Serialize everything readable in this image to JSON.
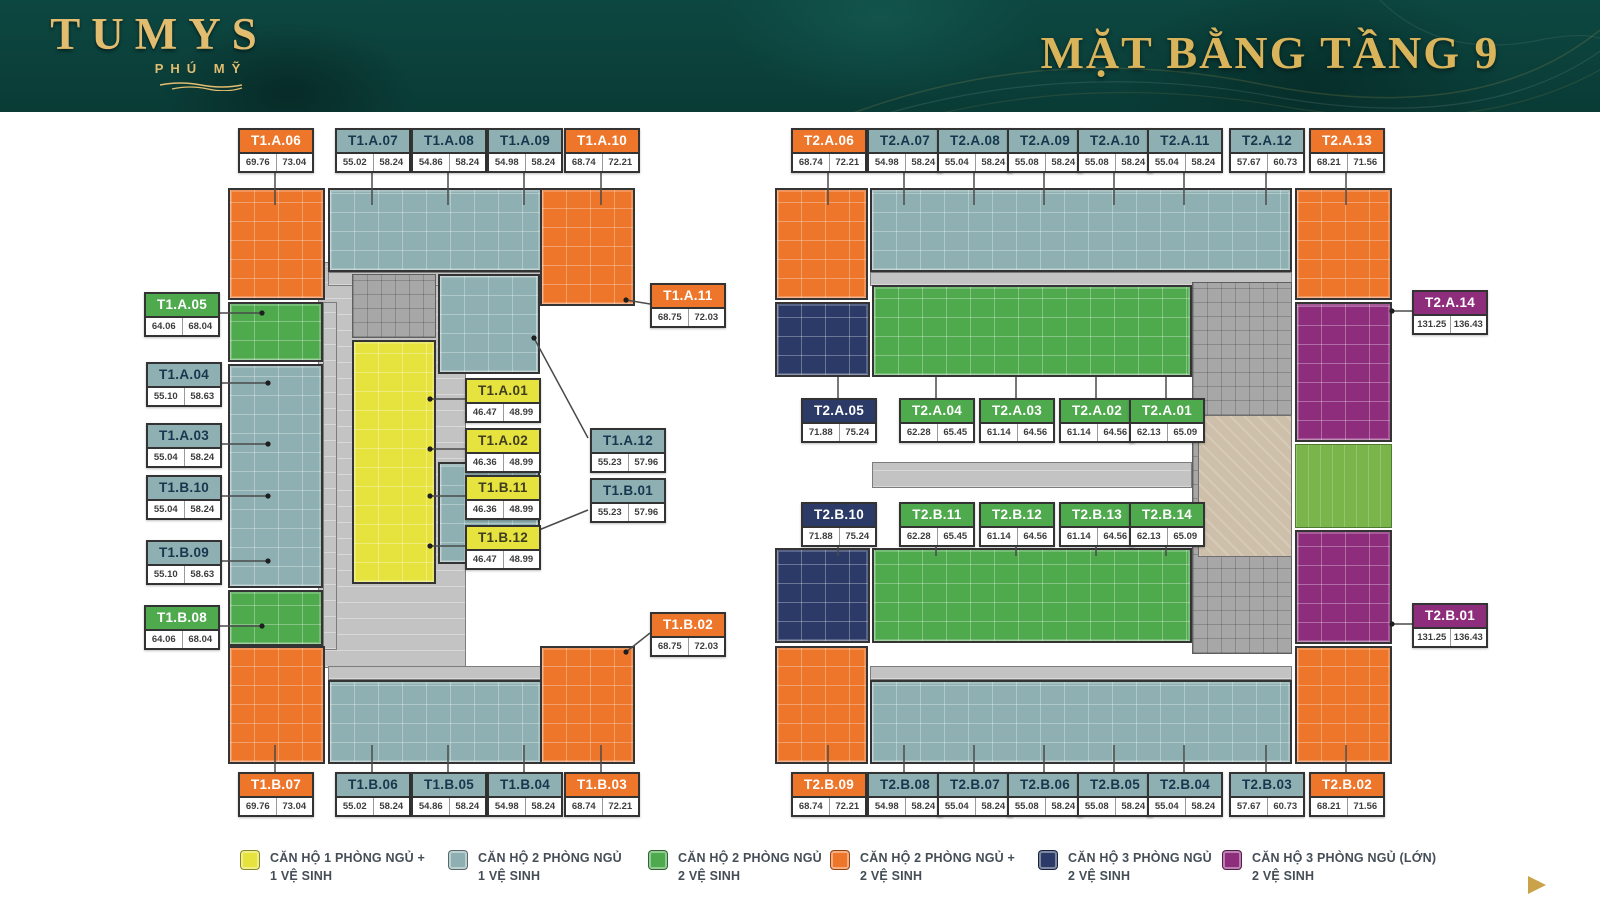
{
  "header": {
    "logo_title": "TUMYS",
    "logo_subtitle": "PHÚ MỸ",
    "page_title": "MẶT BẰNG TẦNG 9"
  },
  "colors": {
    "yellow": "#E6E23E",
    "teal": "#8FB0B2",
    "green": "#4FA94D",
    "orange": "#EE762B",
    "navy": "#2B3A67",
    "purple": "#8E2D7C",
    "header_bg": "#0C4540",
    "gold": "#D9B45B"
  },
  "towers": {
    "t1": {
      "units": [
        {
          "code": "T1.A.06",
          "area1": "69.76",
          "area2": "73.04",
          "type": "orange"
        },
        {
          "code": "T1.A.07",
          "area1": "55.02",
          "area2": "58.24",
          "type": "teal"
        },
        {
          "code": "T1.A.08",
          "area1": "54.86",
          "area2": "58.24",
          "type": "teal"
        },
        {
          "code": "T1.A.09",
          "area1": "54.98",
          "area2": "58.24",
          "type": "teal"
        },
        {
          "code": "T1.A.10",
          "area1": "68.74",
          "area2": "72.21",
          "type": "orange"
        },
        {
          "code": "T1.A.05",
          "area1": "64.06",
          "area2": "68.04",
          "type": "green"
        },
        {
          "code": "T1.A.04",
          "area1": "55.10",
          "area2": "58.63",
          "type": "teal"
        },
        {
          "code": "T1.A.03",
          "area1": "55.04",
          "area2": "58.24",
          "type": "teal"
        },
        {
          "code": "T1.B.10",
          "area1": "55.04",
          "area2": "58.24",
          "type": "teal"
        },
        {
          "code": "T1.B.09",
          "area1": "55.10",
          "area2": "58.63",
          "type": "teal"
        },
        {
          "code": "T1.B.08",
          "area1": "64.06",
          "area2": "68.04",
          "type": "green"
        },
        {
          "code": "T1.A.01",
          "area1": "46.47",
          "area2": "48.99",
          "type": "yellow"
        },
        {
          "code": "T1.A.02",
          "area1": "46.36",
          "area2": "48.99",
          "type": "yellow"
        },
        {
          "code": "T1.B.11",
          "area1": "46.36",
          "area2": "48.99",
          "type": "yellow"
        },
        {
          "code": "T1.B.12",
          "area1": "46.47",
          "area2": "48.99",
          "type": "yellow"
        },
        {
          "code": "T1.A.11",
          "area1": "68.75",
          "area2": "72.03",
          "type": "orange"
        },
        {
          "code": "T1.A.12",
          "area1": "55.23",
          "area2": "57.96",
          "type": "teal"
        },
        {
          "code": "T1.B.01",
          "area1": "55.23",
          "area2": "57.96",
          "type": "teal"
        },
        {
          "code": "T1.B.02",
          "area1": "68.75",
          "area2": "72.03",
          "type": "orange"
        },
        {
          "code": "T1.B.07",
          "area1": "69.76",
          "area2": "73.04",
          "type": "orange"
        },
        {
          "code": "T1.B.06",
          "area1": "55.02",
          "area2": "58.24",
          "type": "teal"
        },
        {
          "code": "T1.B.05",
          "area1": "54.86",
          "area2": "58.24",
          "type": "teal"
        },
        {
          "code": "T1.B.04",
          "area1": "54.98",
          "area2": "58.24",
          "type": "teal"
        },
        {
          "code": "T1.B.03",
          "area1": "68.74",
          "area2": "72.21",
          "type": "orange"
        }
      ]
    },
    "t2": {
      "units": [
        {
          "code": "T2.A.06",
          "area1": "68.74",
          "area2": "72.21",
          "type": "orange"
        },
        {
          "code": "T2.A.07",
          "area1": "54.98",
          "area2": "58.24",
          "type": "teal"
        },
        {
          "code": "T2.A.08",
          "area1": "55.04",
          "area2": "58.24",
          "type": "teal"
        },
        {
          "code": "T2.A.09",
          "area1": "55.08",
          "area2": "58.24",
          "type": "teal"
        },
        {
          "code": "T2.A.10",
          "area1": "55.08",
          "area2": "58.24",
          "type": "teal"
        },
        {
          "code": "T2.A.11",
          "area1": "55.04",
          "area2": "58.24",
          "type": "teal"
        },
        {
          "code": "T2.A.12",
          "area1": "57.67",
          "area2": "60.73",
          "type": "teal"
        },
        {
          "code": "T2.A.13",
          "area1": "68.21",
          "area2": "71.56",
          "type": "orange"
        },
        {
          "code": "T2.A.14",
          "area1": "131.25",
          "area2": "136.43",
          "type": "purple"
        },
        {
          "code": "T2.A.05",
          "area1": "71.88",
          "area2": "75.24",
          "type": "navy"
        },
        {
          "code": "T2.A.04",
          "area1": "62.28",
          "area2": "65.45",
          "type": "green"
        },
        {
          "code": "T2.A.03",
          "area1": "61.14",
          "area2": "64.56",
          "type": "green"
        },
        {
          "code": "T2.A.02",
          "area1": "61.14",
          "area2": "64.56",
          "type": "green"
        },
        {
          "code": "T2.A.01",
          "area1": "62.13",
          "area2": "65.09",
          "type": "green"
        },
        {
          "code": "T2.B.10",
          "area1": "71.88",
          "area2": "75.24",
          "type": "navy"
        },
        {
          "code": "T2.B.11",
          "area1": "62.28",
          "area2": "65.45",
          "type": "green"
        },
        {
          "code": "T2.B.12",
          "area1": "61.14",
          "area2": "64.56",
          "type": "green"
        },
        {
          "code": "T2.B.13",
          "area1": "61.14",
          "area2": "64.56",
          "type": "green"
        },
        {
          "code": "T2.B.14",
          "area1": "62.13",
          "area2": "65.09",
          "type": "green"
        },
        {
          "code": "T2.B.01",
          "area1": "131.25",
          "area2": "136.43",
          "type": "purple"
        },
        {
          "code": "T2.B.09",
          "area1": "68.74",
          "area2": "72.21",
          "type": "orange"
        },
        {
          "code": "T2.B.08",
          "area1": "54.98",
          "area2": "58.24",
          "type": "teal"
        },
        {
          "code": "T2.B.07",
          "area1": "55.04",
          "area2": "58.24",
          "type": "teal"
        },
        {
          "code": "T2.B.06",
          "area1": "55.08",
          "area2": "58.24",
          "type": "teal"
        },
        {
          "code": "T2.B.05",
          "area1": "55.08",
          "area2": "58.24",
          "type": "teal"
        },
        {
          "code": "T2.B.04",
          "area1": "55.04",
          "area2": "58.24",
          "type": "teal"
        },
        {
          "code": "T2.B.03",
          "area1": "57.67",
          "area2": "60.73",
          "type": "teal"
        },
        {
          "code": "T2.B.02",
          "area1": "68.21",
          "area2": "71.56",
          "type": "orange"
        }
      ]
    }
  },
  "legend": [
    {
      "type": "yellow",
      "line1": "CĂN HỘ 1 PHÒNG NGỦ +",
      "line2": "1 VỆ SINH"
    },
    {
      "type": "teal",
      "line1": "CĂN HỘ 2 PHÒNG NGỦ",
      "line2": "1 VỆ SINH"
    },
    {
      "type": "green",
      "line1": "CĂN HỘ 2 PHÒNG NGỦ",
      "line2": "2 VỆ SINH"
    },
    {
      "type": "orange",
      "line1": "CĂN HỘ 2 PHÒNG NGỦ +",
      "line2": "2 VỆ SINH"
    },
    {
      "type": "navy",
      "line1": "CĂN HỘ 3 PHÒNG NGỦ",
      "line2": "2 VỆ SINH"
    },
    {
      "type": "purple",
      "line1": "CĂN HỘ 3 PHÒNG NGỦ (LỚN)",
      "line2": "2 VỆ SINH"
    }
  ]
}
